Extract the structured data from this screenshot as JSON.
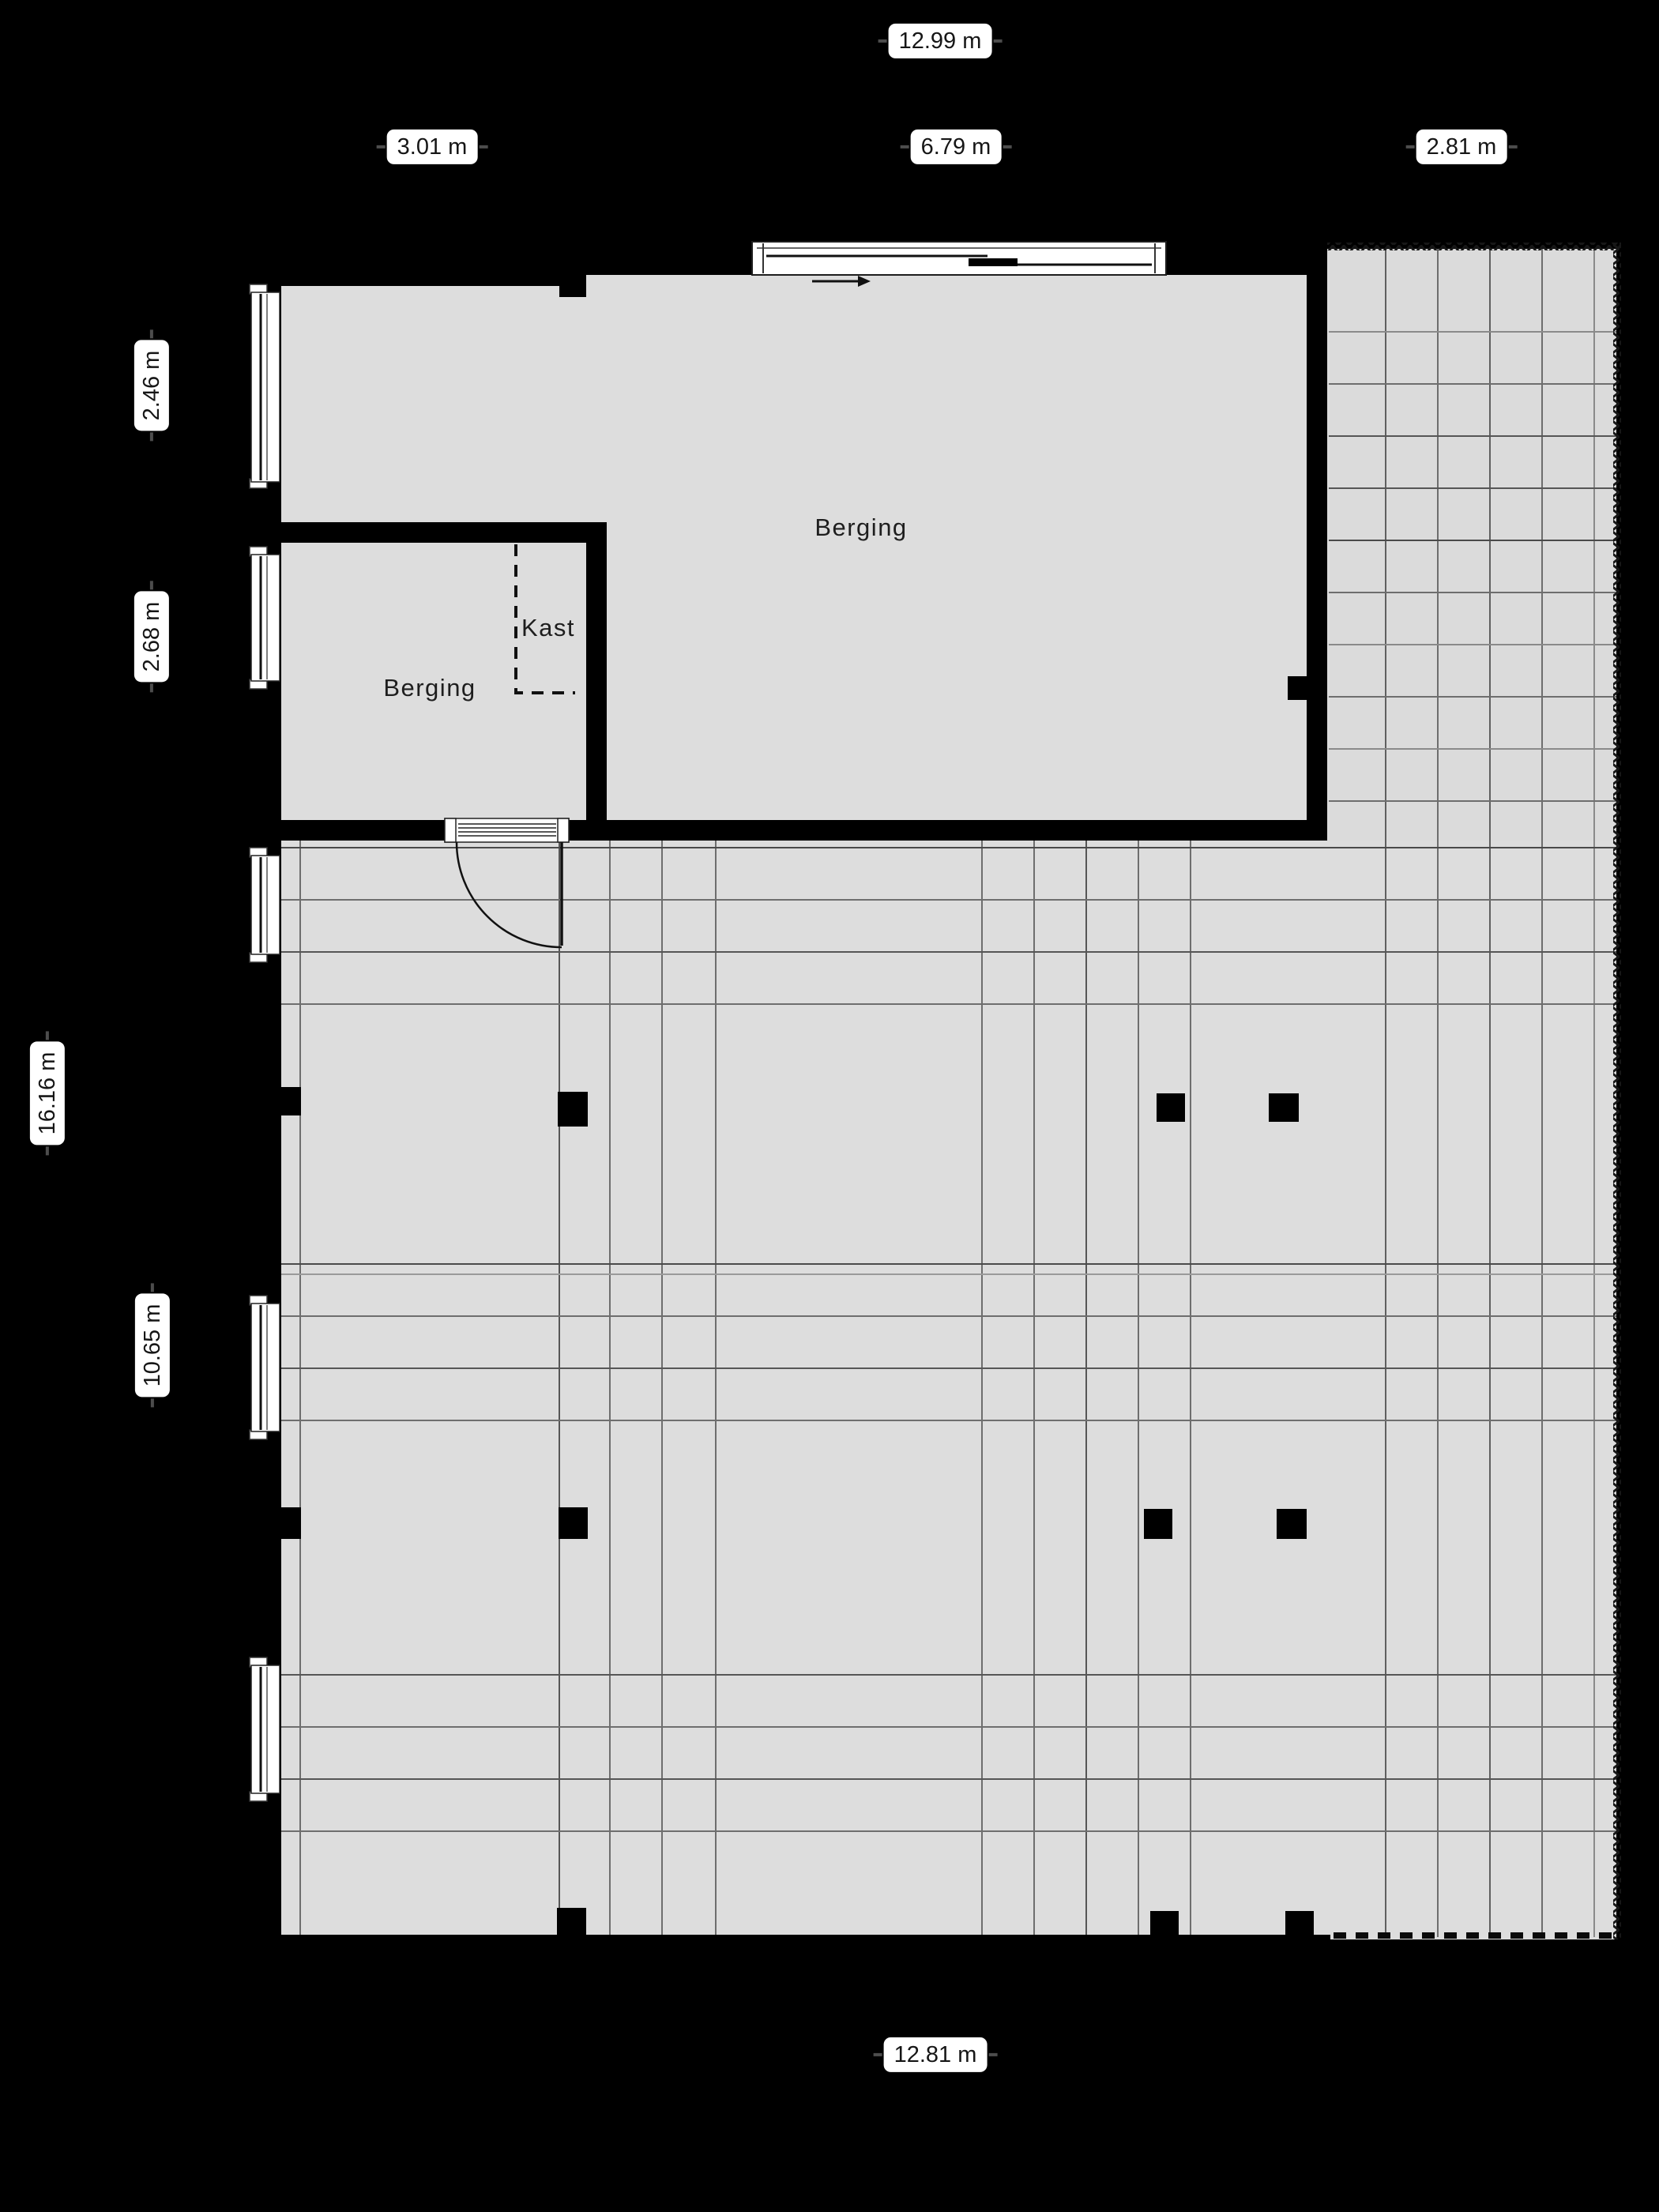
{
  "plan": {
    "kind": "floor plan",
    "floor_name": "Berging / storage floor plan"
  },
  "dimension_labels": {
    "top_total": "12.99 m",
    "top_left": "3.01 m",
    "top_middle": "6.79 m",
    "top_right": "2.81 m",
    "left_upper": "2.46 m",
    "left_middle": "2.68 m",
    "left_total": "16.16 m",
    "left_lower": "10.65 m",
    "bottom_total": "12.81 m"
  },
  "room_labels": {
    "storage_main": "Berging",
    "storage_small": "Berging",
    "closet": "Kast"
  },
  "colors": {
    "background": "#000000",
    "wall": "#000000",
    "floor": "#dddddd",
    "tile_line": "#6e6e6e",
    "tile_line_dark": "#4a4a4a",
    "label_background": "#ffffff",
    "label_text": "#161616"
  }
}
